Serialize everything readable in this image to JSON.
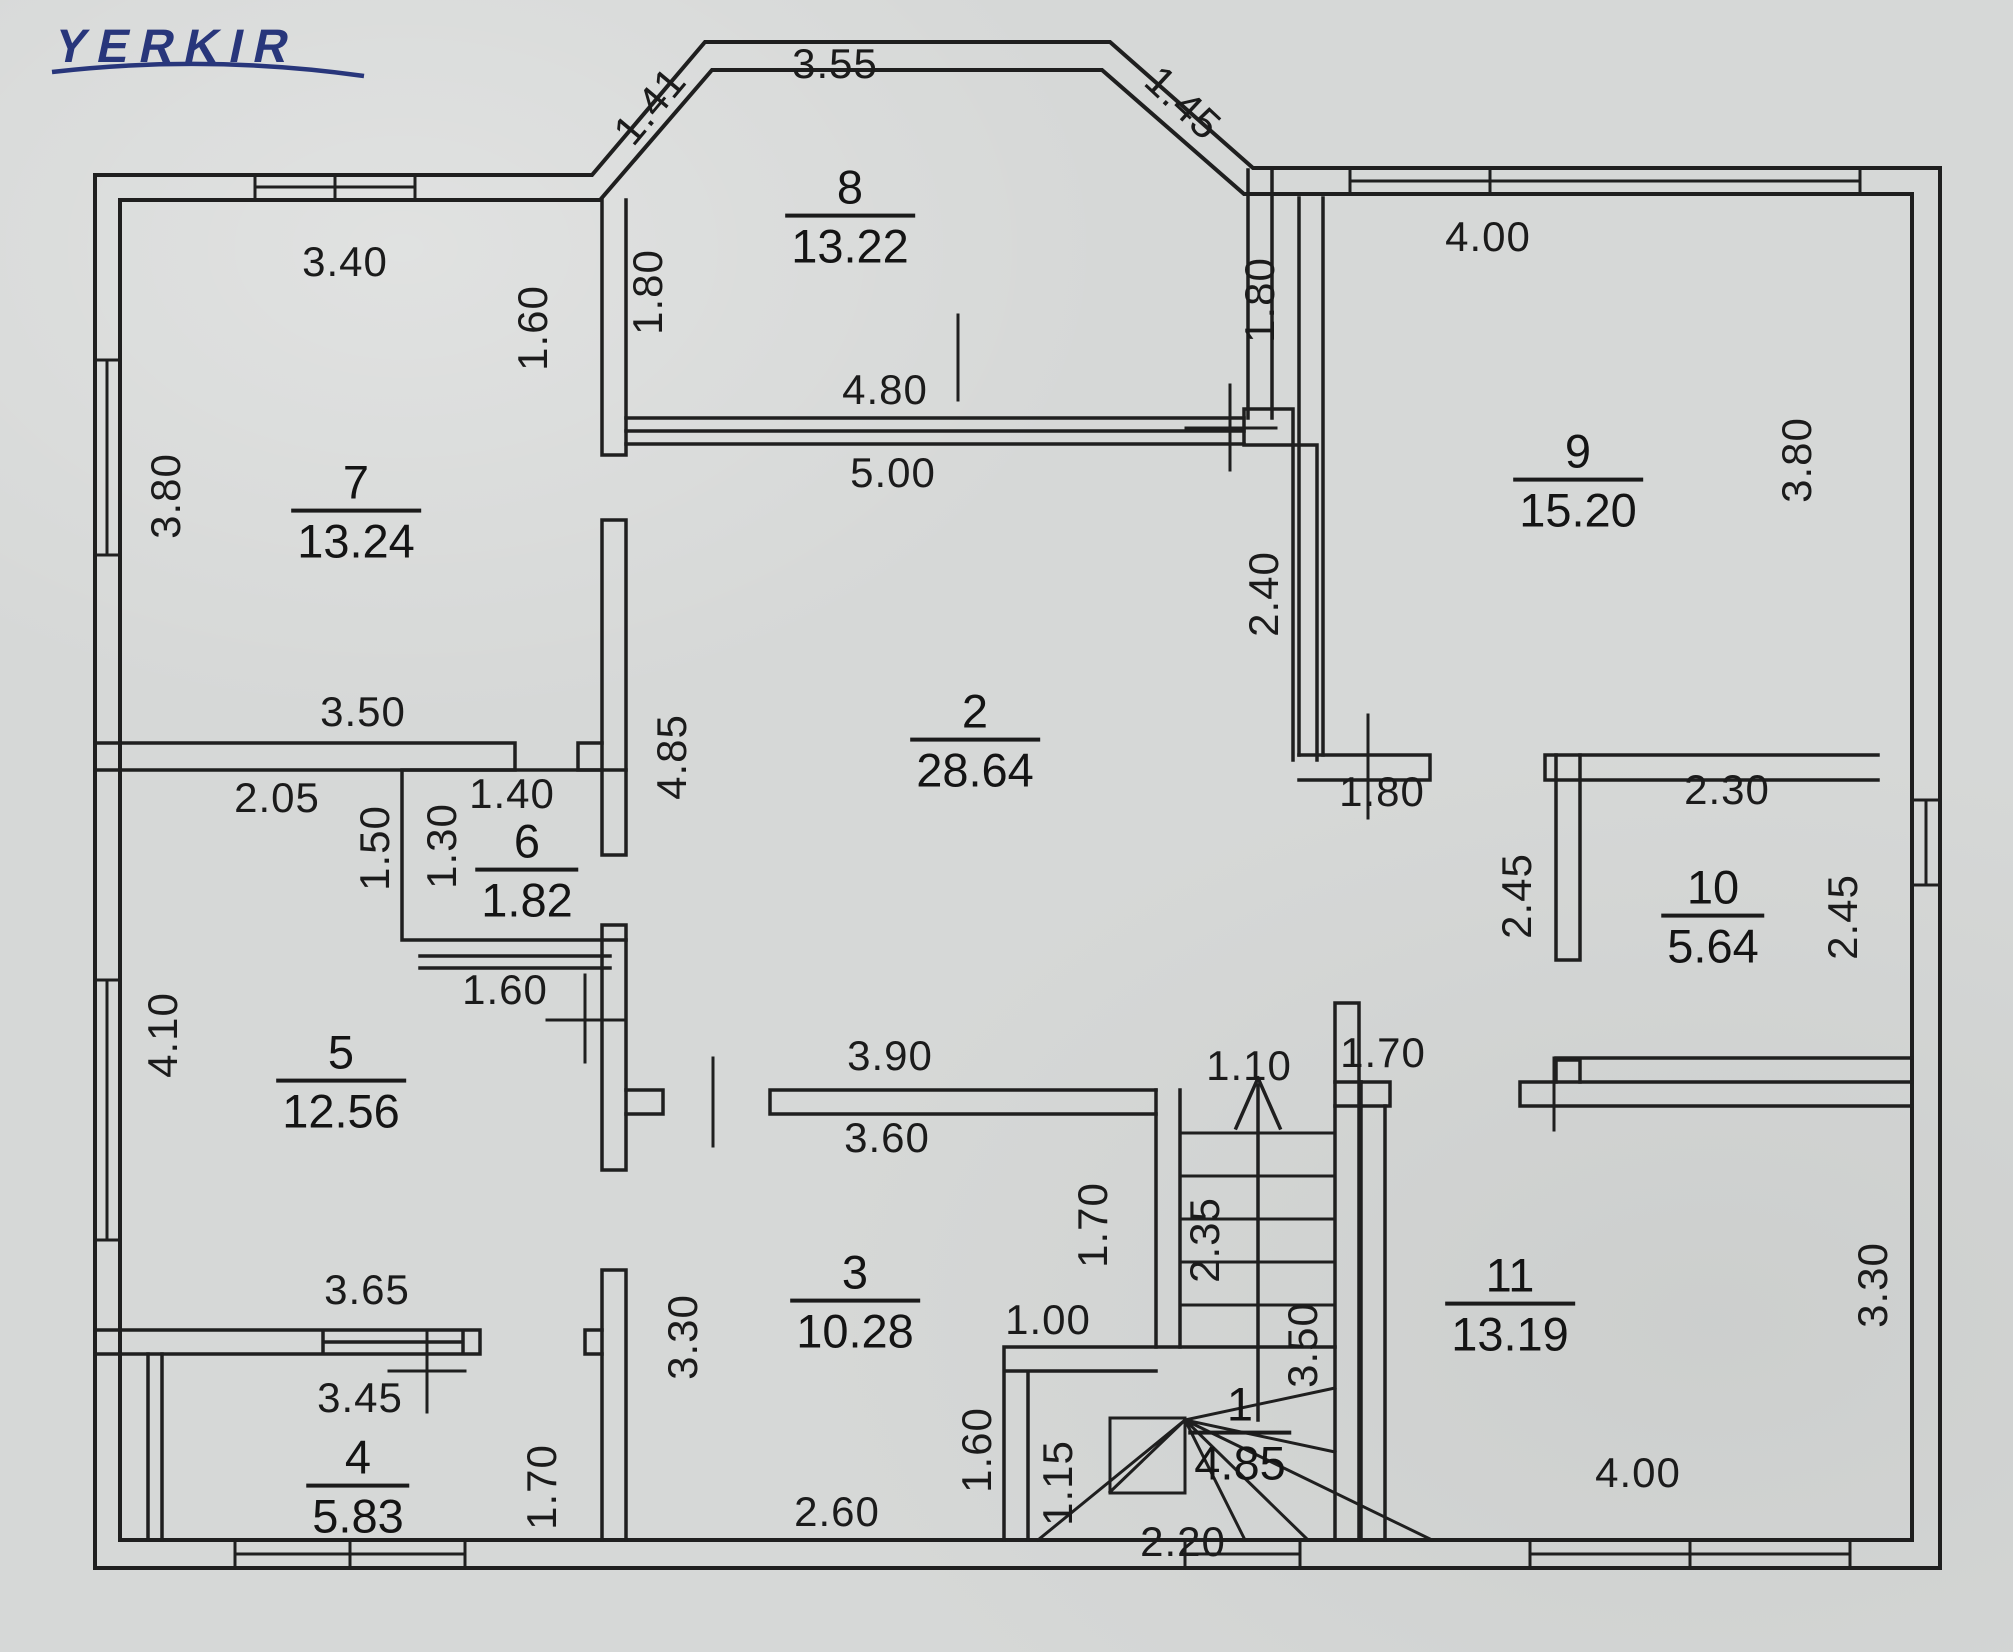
{
  "logo": {
    "text": "YERKIR",
    "color": "#28367b"
  },
  "floorplan": {
    "canvas": {
      "width": 2013,
      "height": 1652,
      "paper_color": "#d6d8d7",
      "line_color": "#1f1f1f"
    },
    "rooms": [
      {
        "number": "8",
        "area": "13.22",
        "x": 850,
        "y": 218
      },
      {
        "number": "7",
        "area": "13.24",
        "x": 356,
        "y": 513
      },
      {
        "number": "9",
        "area": "15.20",
        "x": 1578,
        "y": 482
      },
      {
        "number": "2",
        "area": "28.64",
        "x": 975,
        "y": 742
      },
      {
        "number": "6",
        "area": "1.82",
        "x": 527,
        "y": 872
      },
      {
        "number": "10",
        "area": "5.64",
        "x": 1713,
        "y": 918
      },
      {
        "number": "5",
        "area": "12.56",
        "x": 341,
        "y": 1083
      },
      {
        "number": "3",
        "area": "10.28",
        "x": 855,
        "y": 1303
      },
      {
        "number": "11",
        "area": "13.19",
        "x": 1510,
        "y": 1306
      },
      {
        "number": "4",
        "area": "5.83",
        "x": 358,
        "y": 1488
      },
      {
        "number": "1",
        "area": "4.85",
        "x": 1240,
        "y": 1435
      }
    ],
    "dimensions": [
      {
        "text": "3.55",
        "x": 835,
        "y": 64,
        "rot": 0
      },
      {
        "text": "1.41",
        "x": 650,
        "y": 106,
        "rot": -50
      },
      {
        "text": "1.45",
        "x": 1183,
        "y": 103,
        "rot": 43
      },
      {
        "text": "3.40",
        "x": 345,
        "y": 262,
        "rot": 0
      },
      {
        "text": "4.00",
        "x": 1488,
        "y": 237,
        "rot": 0
      },
      {
        "text": "1.80",
        "x": 648,
        "y": 292,
        "rot": -90
      },
      {
        "text": "1.80",
        "x": 1260,
        "y": 300,
        "rot": -90
      },
      {
        "text": "1.60",
        "x": 533,
        "y": 328,
        "rot": -90
      },
      {
        "text": "3.80",
        "x": 166,
        "y": 496,
        "rot": -90
      },
      {
        "text": "3.80",
        "x": 1797,
        "y": 460,
        "rot": -90
      },
      {
        "text": "4.80",
        "x": 885,
        "y": 390,
        "rot": 0
      },
      {
        "text": "5.00",
        "x": 893,
        "y": 473,
        "rot": 0
      },
      {
        "text": "2.40",
        "x": 1264,
        "y": 594,
        "rot": -90
      },
      {
        "text": "4.85",
        "x": 672,
        "y": 757,
        "rot": -90
      },
      {
        "text": "3.50",
        "x": 363,
        "y": 712,
        "rot": 0
      },
      {
        "text": "2.05",
        "x": 277,
        "y": 798,
        "rot": 0
      },
      {
        "text": "1.40",
        "x": 512,
        "y": 794,
        "rot": 0
      },
      {
        "text": "1.50",
        "x": 375,
        "y": 848,
        "rot": -90
      },
      {
        "text": "1.30",
        "x": 442,
        "y": 846,
        "rot": -90
      },
      {
        "text": "1.80",
        "x": 1382,
        "y": 792,
        "rot": 0
      },
      {
        "text": "2.30",
        "x": 1727,
        "y": 790,
        "rot": 0
      },
      {
        "text": "1.60",
        "x": 505,
        "y": 990,
        "rot": 0
      },
      {
        "text": "2.45",
        "x": 1517,
        "y": 896,
        "rot": -90
      },
      {
        "text": "2.45",
        "x": 1843,
        "y": 917,
        "rot": -90
      },
      {
        "text": "4.10",
        "x": 163,
        "y": 1035,
        "rot": -90
      },
      {
        "text": "3.90",
        "x": 890,
        "y": 1056,
        "rot": 0
      },
      {
        "text": "1.10",
        "x": 1249,
        "y": 1066,
        "rot": 0
      },
      {
        "text": "1.70",
        "x": 1383,
        "y": 1053,
        "rot": 0
      },
      {
        "text": "3.60",
        "x": 887,
        "y": 1138,
        "rot": 0
      },
      {
        "text": "3.30",
        "x": 683,
        "y": 1337,
        "rot": -90
      },
      {
        "text": "1.70",
        "x": 1093,
        "y": 1225,
        "rot": -90
      },
      {
        "text": "2.35",
        "x": 1205,
        "y": 1240,
        "rot": -90
      },
      {
        "text": "3.50",
        "x": 1303,
        "y": 1345,
        "rot": -90
      },
      {
        "text": "1.00",
        "x": 1048,
        "y": 1320,
        "rot": 0
      },
      {
        "text": "3.65",
        "x": 367,
        "y": 1290,
        "rot": 0
      },
      {
        "text": "3.45",
        "x": 360,
        "y": 1398,
        "rot": 0
      },
      {
        "text": "1.70",
        "x": 542,
        "y": 1487,
        "rot": -90
      },
      {
        "text": "1.60",
        "x": 977,
        "y": 1450,
        "rot": -90
      },
      {
        "text": "1.15",
        "x": 1058,
        "y": 1483,
        "rot": -90
      },
      {
        "text": "2.60",
        "x": 837,
        "y": 1512,
        "rot": 0
      },
      {
        "text": "2.20",
        "x": 1183,
        "y": 1542,
        "rot": 0
      },
      {
        "text": "4.00",
        "x": 1638,
        "y": 1473,
        "rot": 0
      },
      {
        "text": "3.30",
        "x": 1873,
        "y": 1285,
        "rot": -90
      }
    ]
  }
}
